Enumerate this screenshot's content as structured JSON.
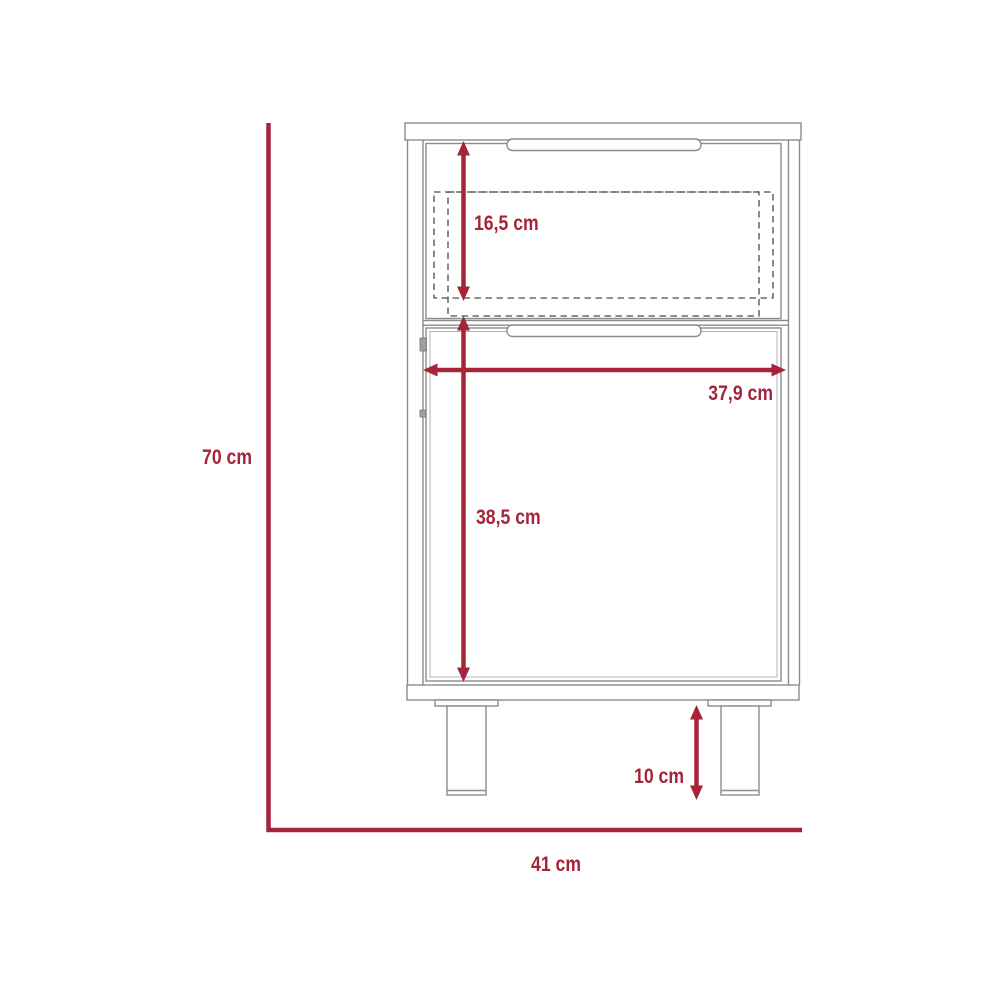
{
  "drawing": {
    "type": "furniture-dimension-diagram",
    "dimensions": {
      "overall_height": "70 cm",
      "overall_width": "41 cm",
      "drawer_height": "16,5 cm",
      "interior_width": "37,9 cm",
      "door_height": "38,5 cm",
      "leg_height": "10 cm"
    },
    "colors": {
      "dimension": "#A5243A",
      "outline": "#8C8C8C",
      "dashed": "#4C4C4C"
    }
  }
}
